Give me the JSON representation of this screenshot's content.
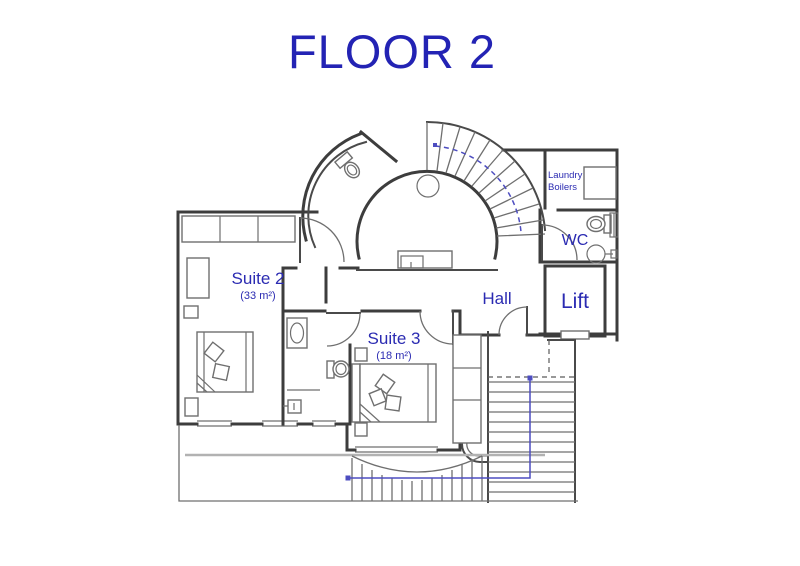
{
  "title": {
    "text": "FLOOR 2",
    "color": "#2323b4"
  },
  "plan": {
    "rooms": {
      "suite2": {
        "label": "Suite 2",
        "area": "(33 m²)"
      },
      "suite3": {
        "label": "Suite 3",
        "area": "(18 m²)"
      },
      "hall": {
        "label": "Hall"
      },
      "lift": {
        "label": "Lift"
      },
      "wc": {
        "label": "WC"
      },
      "laundry": {
        "line1": "Laundry",
        "line2": "Boilers"
      }
    },
    "icons": {
      "spiral_stair": "curved-staircase",
      "straight_stair": "straight-staircase",
      "beds": 2,
      "toilets": 3,
      "sinks": 3,
      "boiler": 1
    },
    "colors": {
      "label_blue": "#2b2bb2",
      "wall_gray": "#3d3d3d",
      "furniture_gray": "#6f6f6f",
      "route_blue": "#4d4dc0",
      "railing_gray": "#b2b2b2",
      "background": "#ffffff"
    }
  }
}
